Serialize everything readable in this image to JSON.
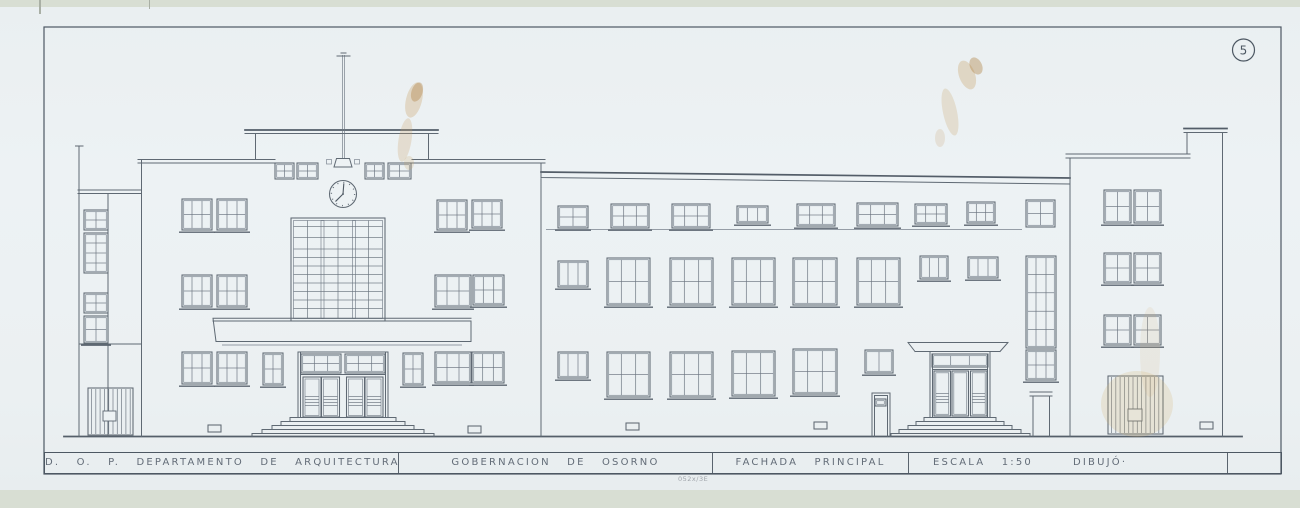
{
  "sheet": {
    "number": "5"
  },
  "title_block": {
    "department": "D. O. P.  DEPARTAMENTO  DE  ARQUITECTURA",
    "project": "GOBERNACION  DE  OSORNO",
    "view": "FACHADA  PRINCIPAL",
    "scale": "ESCALA  1:50",
    "drawn_by": "DIBUJÓ·",
    "pencil_note": "052x/3E"
  },
  "drawing": {
    "subject": "building-front-elevation",
    "clock_time": "7:00",
    "colors": {
      "paper": "#edf2f4",
      "ink": "#5f6973",
      "stain": "#c9a268"
    },
    "windows": [
      [
        84,
        210,
        24,
        20,
        2,
        2,
        0
      ],
      [
        84,
        233,
        24,
        40,
        2,
        4,
        0
      ],
      [
        84,
        293,
        24,
        20,
        2,
        2,
        0
      ],
      [
        84,
        316,
        24,
        27,
        2,
        2,
        1
      ],
      [
        182,
        199,
        30,
        31,
        3,
        2,
        1
      ],
      [
        217,
        199,
        30,
        31,
        3,
        2,
        1
      ],
      [
        182,
        275,
        30,
        32,
        3,
        2,
        1
      ],
      [
        217,
        275,
        30,
        32,
        3,
        2,
        1
      ],
      [
        182,
        352,
        30,
        32,
        3,
        2,
        1
      ],
      [
        217,
        352,
        30,
        32,
        3,
        2,
        1
      ],
      [
        275,
        163,
        19,
        16,
        2,
        2,
        0
      ],
      [
        297,
        163,
        21,
        16,
        2,
        2,
        0
      ],
      [
        365,
        163,
        19,
        16,
        2,
        2,
        0
      ],
      [
        388,
        163,
        23,
        16,
        2,
        2,
        0
      ],
      [
        263,
        353,
        20,
        32,
        2,
        2,
        1
      ],
      [
        403,
        353,
        20,
        32,
        2,
        2,
        1
      ],
      [
        437,
        200,
        30,
        30,
        3,
        2,
        1
      ],
      [
        472,
        200,
        30,
        28,
        3,
        2,
        1
      ],
      [
        435,
        275,
        36,
        32,
        3,
        2,
        1
      ],
      [
        473,
        275,
        31,
        30,
        3,
        2,
        1
      ],
      [
        435,
        352,
        36,
        31,
        3,
        2,
        1
      ],
      [
        472,
        352,
        32,
        31,
        3,
        2,
        1
      ],
      [
        558,
        206,
        30,
        22,
        2,
        2,
        1
      ],
      [
        611,
        204,
        38,
        24,
        3,
        2,
        1
      ],
      [
        672,
        204,
        38,
        24,
        3,
        2,
        1
      ],
      [
        737,
        206,
        31,
        17,
        3,
        1,
        1
      ],
      [
        797,
        204,
        38,
        22,
        3,
        2,
        1
      ],
      [
        857,
        203,
        41,
        23,
        3,
        2,
        1
      ],
      [
        915,
        204,
        32,
        20,
        3,
        2,
        1
      ],
      [
        967,
        202,
        28,
        21,
        3,
        2,
        1
      ],
      [
        558,
        261,
        30,
        26,
        3,
        1,
        1
      ],
      [
        607,
        258,
        43,
        47,
        3,
        2,
        1
      ],
      [
        670,
        258,
        43,
        47,
        3,
        2,
        1
      ],
      [
        732,
        258,
        43,
        47,
        3,
        2,
        1
      ],
      [
        793,
        258,
        44,
        47,
        3,
        2,
        1
      ],
      [
        857,
        258,
        43,
        47,
        3,
        2,
        1
      ],
      [
        920,
        256,
        28,
        23,
        3,
        1,
        1
      ],
      [
        968,
        257,
        30,
        21,
        3,
        1,
        1
      ],
      [
        558,
        352,
        30,
        26,
        3,
        1,
        1
      ],
      [
        607,
        352,
        43,
        45,
        3,
        2,
        1
      ],
      [
        670,
        352,
        43,
        45,
        3,
        2,
        1
      ],
      [
        732,
        351,
        43,
        45,
        3,
        2,
        1
      ],
      [
        793,
        349,
        44,
        45,
        3,
        2,
        1
      ],
      [
        865,
        350,
        28,
        23,
        2,
        1,
        1
      ],
      [
        301,
        354,
        40,
        19,
        3,
        2,
        0
      ],
      [
        345,
        354,
        40,
        19,
        3,
        2,
        0
      ],
      [
        932,
        354,
        56,
        13,
        3,
        1,
        0
      ],
      [
        875,
        399,
        11,
        7,
        1,
        1,
        0
      ],
      [
        1026,
        200,
        29,
        27,
        2,
        2,
        0
      ],
      [
        1026,
        256,
        30,
        92,
        3,
        5,
        0
      ],
      [
        1026,
        350,
        30,
        30,
        3,
        2,
        1
      ],
      [
        1104,
        190,
        27,
        33,
        2,
        2,
        1
      ],
      [
        1134,
        190,
        27,
        33,
        2,
        2,
        1
      ],
      [
        1104,
        253,
        27,
        30,
        2,
        2,
        1
      ],
      [
        1134,
        253,
        27,
        30,
        2,
        2,
        1
      ],
      [
        1104,
        315,
        27,
        30,
        2,
        2,
        1
      ],
      [
        1134,
        315,
        27,
        30,
        2,
        2,
        1
      ]
    ],
    "gates": [
      {
        "x": 88,
        "y": 388,
        "w": 45,
        "h": 47,
        "box": [
          15,
          23,
          13,
          10
        ]
      },
      {
        "x": 1108,
        "y": 376,
        "w": 55,
        "h": 58,
        "box": [
          20,
          33,
          14,
          12
        ]
      }
    ]
  }
}
